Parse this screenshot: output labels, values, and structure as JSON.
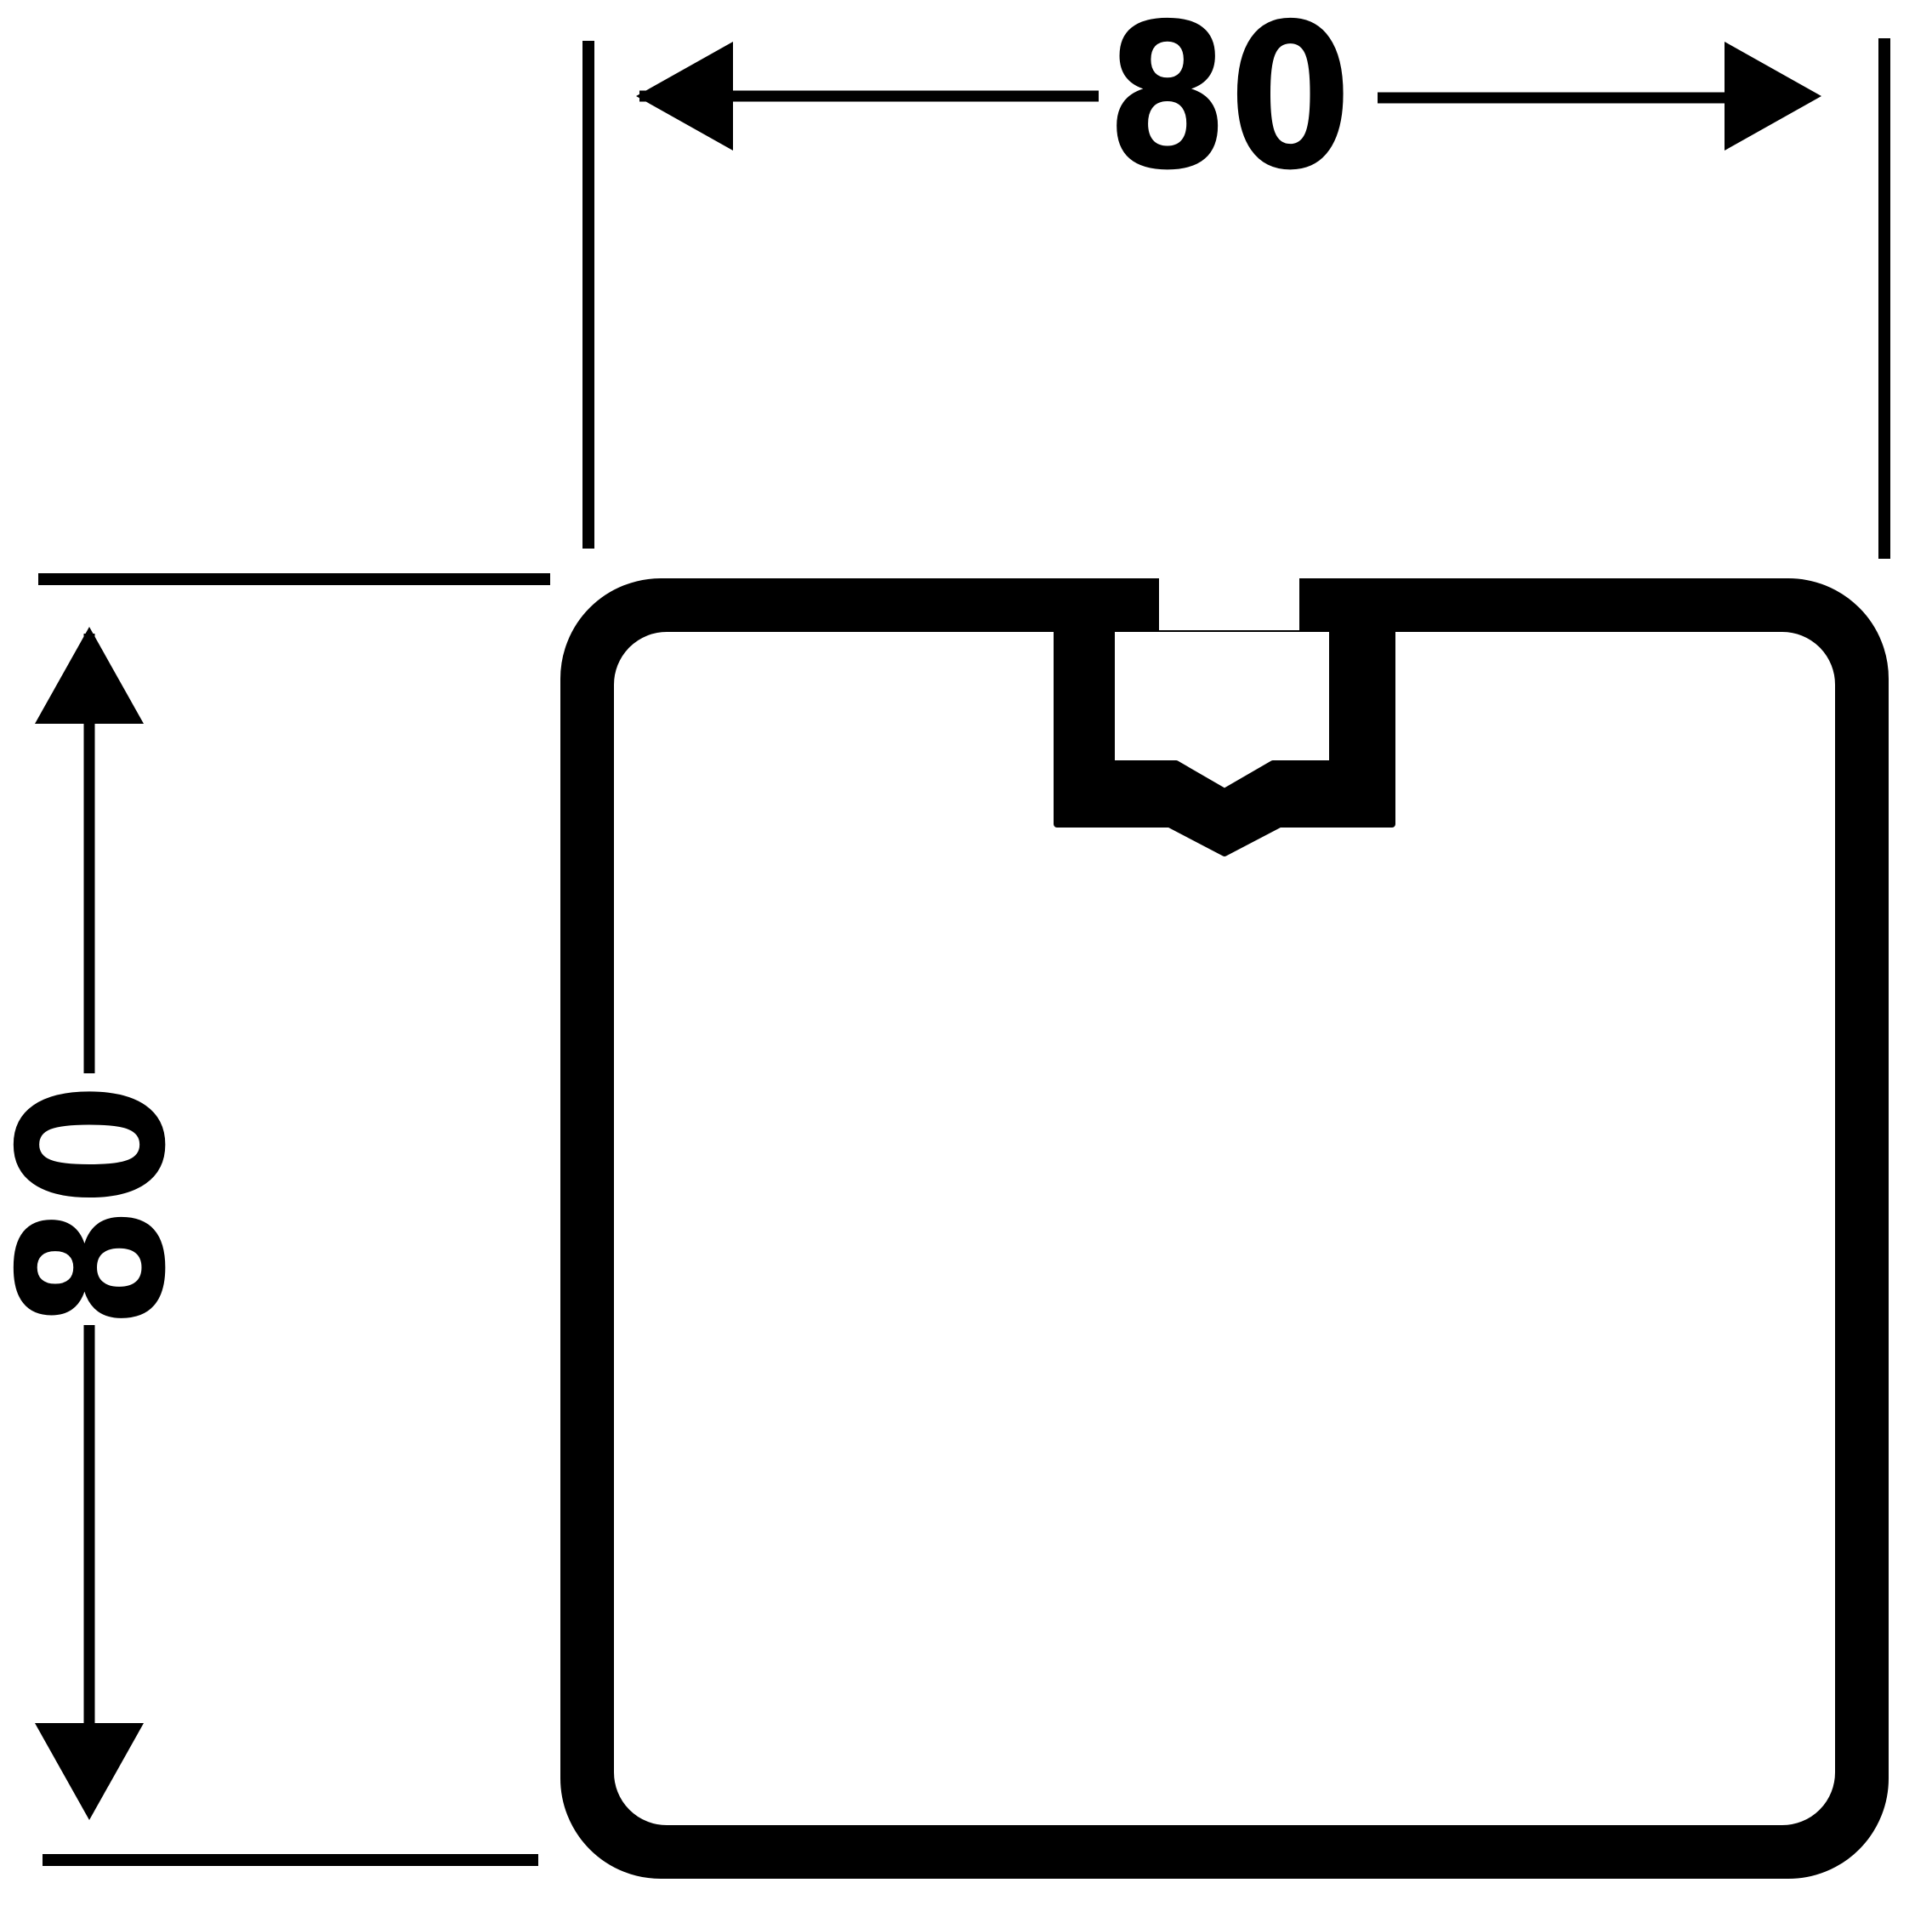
{
  "drawing": {
    "type": "technical-cross-section-drawing",
    "subject": "square hollow extrusion profile with central T-slot screw channel, dimensioned 80 x 80",
    "width_dimension": {
      "label": "80"
    },
    "height_dimension": {
      "label": "80"
    },
    "colors": {
      "ink": "#000000",
      "paper": "#ffffff"
    }
  }
}
